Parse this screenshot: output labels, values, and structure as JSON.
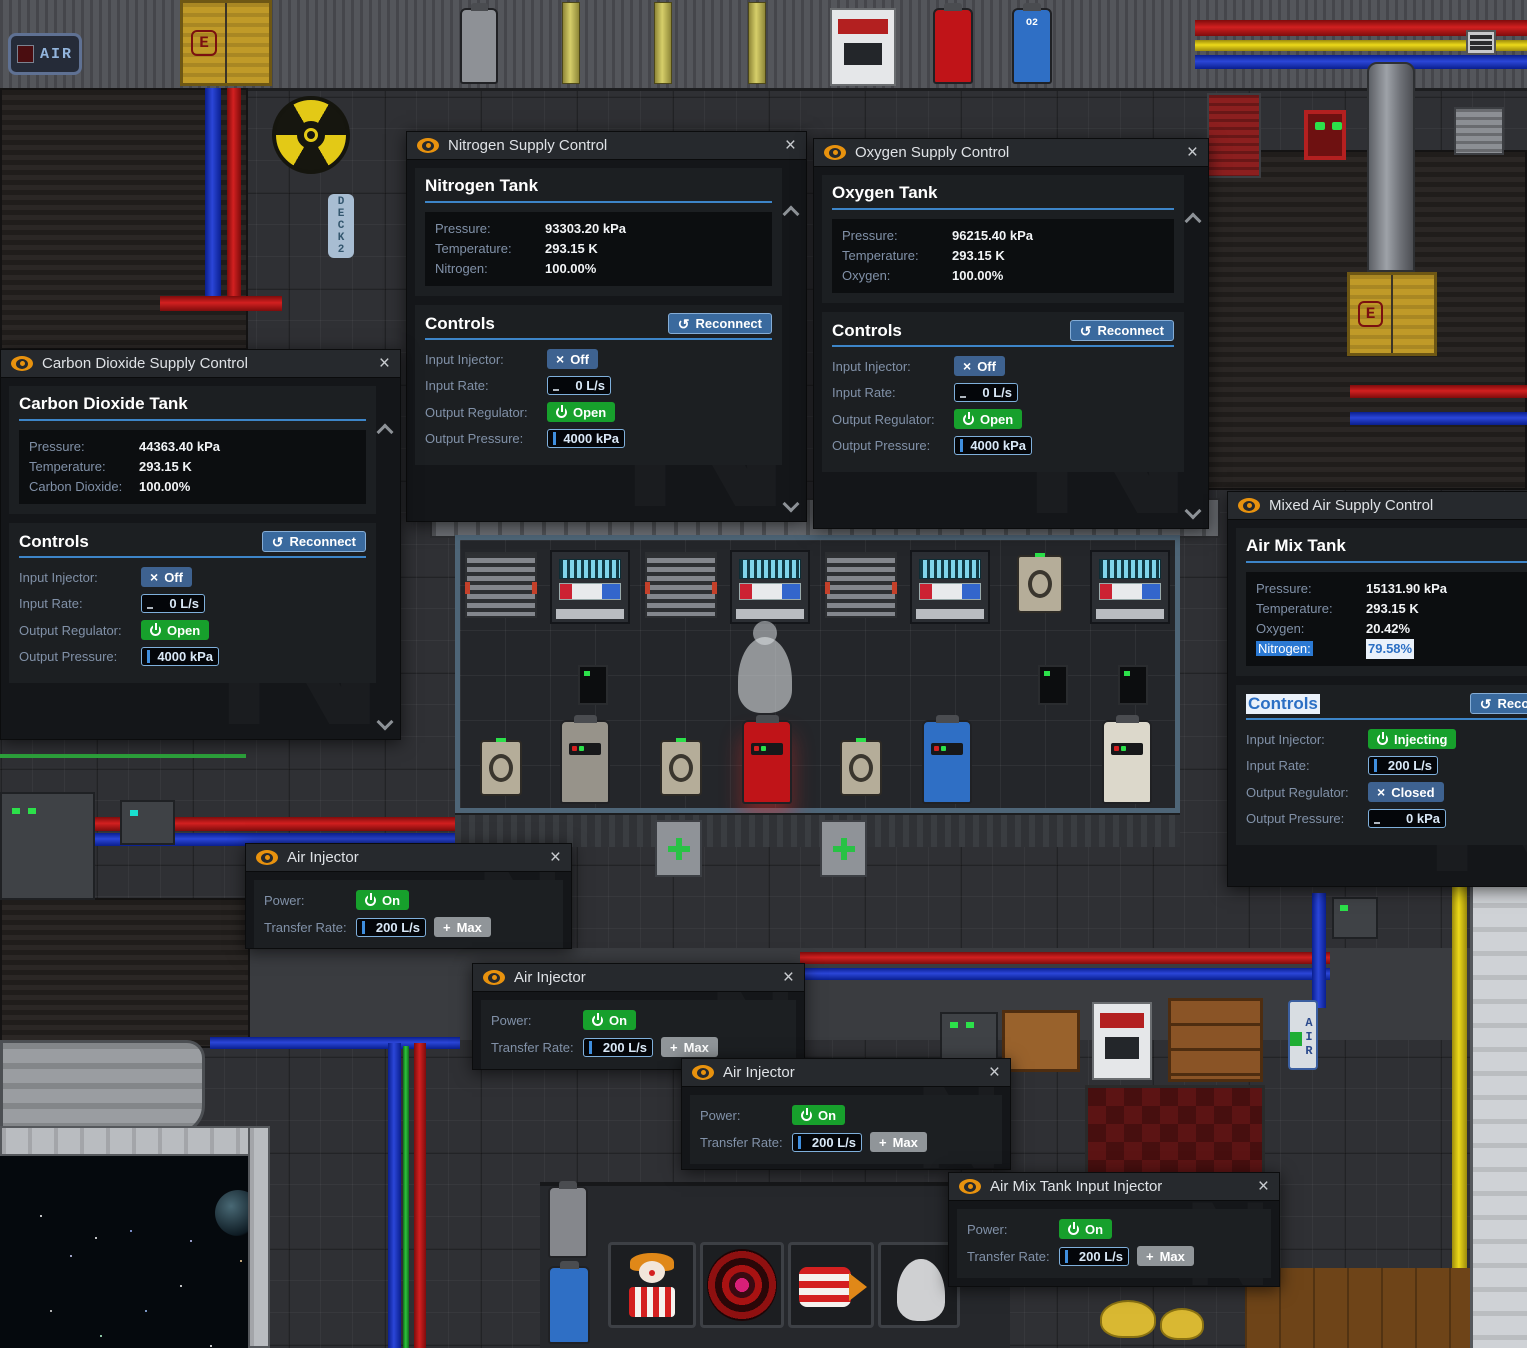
{
  "colors": {
    "accent_blue": "#3d85c8",
    "button_blue": "#3e6290",
    "button_green": "#17a02c",
    "button_gray": "#909599",
    "reconnect_blue": "#3a6a9e",
    "selection_blue": "#2b79d3",
    "title_orange": "#e8920e",
    "input_border": "#7fb0dc"
  },
  "icons": {
    "close": "×",
    "x": "×",
    "reconnect_arrow": "↺",
    "plus": "+",
    "watermark": "N"
  },
  "supply_windows": [
    {
      "title": "Carbon Dioxide Supply Control",
      "tank_title": "Carbon Dioxide Tank",
      "stats": [
        {
          "label": "Pressure:",
          "value": "44363.40 kPa"
        },
        {
          "label": "Temperature:",
          "value": "293.15 K"
        },
        {
          "label": "Carbon Dioxide:",
          "value": "100.00%"
        }
      ],
      "controls_title": "Controls",
      "reconnect_label": "Reconnect",
      "injector_label": "Input Injector:",
      "injector_state": "Off",
      "rate_label": "Input Rate:",
      "rate_value": "0 L/s",
      "regulator_label": "Output Regulator:",
      "regulator_state": "Open",
      "pressure_label": "Output Pressure:",
      "pressure_value": "4000 kPa"
    },
    {
      "title": "Nitrogen Supply Control",
      "tank_title": "Nitrogen Tank",
      "stats": [
        {
          "label": "Pressure:",
          "value": "93303.20 kPa"
        },
        {
          "label": "Temperature:",
          "value": "293.15 K"
        },
        {
          "label": "Nitrogen:",
          "value": "100.00%"
        }
      ],
      "controls_title": "Controls",
      "reconnect_label": "Reconnect",
      "injector_label": "Input Injector:",
      "injector_state": "Off",
      "rate_label": "Input Rate:",
      "rate_value": "0 L/s",
      "regulator_label": "Output Regulator:",
      "regulator_state": "Open",
      "pressure_label": "Output Pressure:",
      "pressure_value": "4000 kPa"
    },
    {
      "title": "Oxygen Supply Control",
      "tank_title": "Oxygen Tank",
      "stats": [
        {
          "label": "Pressure:",
          "value": "96215.40 kPa"
        },
        {
          "label": "Temperature:",
          "value": "293.15 K"
        },
        {
          "label": "Oxygen:",
          "value": "100.00%"
        }
      ],
      "controls_title": "Controls",
      "reconnect_label": "Reconnect",
      "injector_label": "Input Injector:",
      "injector_state": "Off",
      "rate_label": "Input Rate:",
      "rate_value": "0 L/s",
      "regulator_label": "Output Regulator:",
      "regulator_state": "Open",
      "pressure_label": "Output Pressure:",
      "pressure_value": "4000 kPa"
    },
    {
      "title": "Mixed Air Supply Control",
      "tank_title": "Air Mix Tank",
      "stats": [
        {
          "label": "Pressure:",
          "value": "15131.90 kPa"
        },
        {
          "label": "Temperature:",
          "value": "293.15 K"
        },
        {
          "label": "Oxygen:",
          "value": "20.42%"
        },
        {
          "label": "Nitrogen:",
          "value": "79.58%"
        }
      ],
      "controls_title": "Controls",
      "reconnect_label": "Reconnect",
      "injector_label": "Input Injector:",
      "injector_state": "Injecting",
      "rate_label": "Input Rate:",
      "rate_value": "200 L/s",
      "regulator_label": "Output Regulator:",
      "regulator_state": "Closed",
      "pressure_label": "Output Pressure:",
      "pressure_value": "0 kPa"
    }
  ],
  "injector_windows": [
    {
      "title": "Air Injector",
      "power_label": "Power:",
      "power_state": "On",
      "rate_label": "Transfer Rate:",
      "rate_value": "200 L/s",
      "max_label": "Max"
    },
    {
      "title": "Air Injector",
      "power_label": "Power:",
      "power_state": "On",
      "rate_label": "Transfer Rate:",
      "rate_value": "200 L/s",
      "max_label": "Max"
    },
    {
      "title": "Air Injector",
      "power_label": "Power:",
      "power_state": "On",
      "rate_label": "Transfer Rate:",
      "rate_value": "200 L/s",
      "max_label": "Max"
    },
    {
      "title": "Air Mix Tank Input Injector",
      "power_label": "Power:",
      "power_state": "On",
      "rate_label": "Transfer Rate:",
      "rate_value": "200 L/s",
      "max_label": "Max"
    }
  ],
  "background": {
    "air_sign_top": "AIR",
    "air_sign_right": "AIR",
    "deck_sign": "DECK2",
    "door_label": "E",
    "canister_label": "O2"
  }
}
